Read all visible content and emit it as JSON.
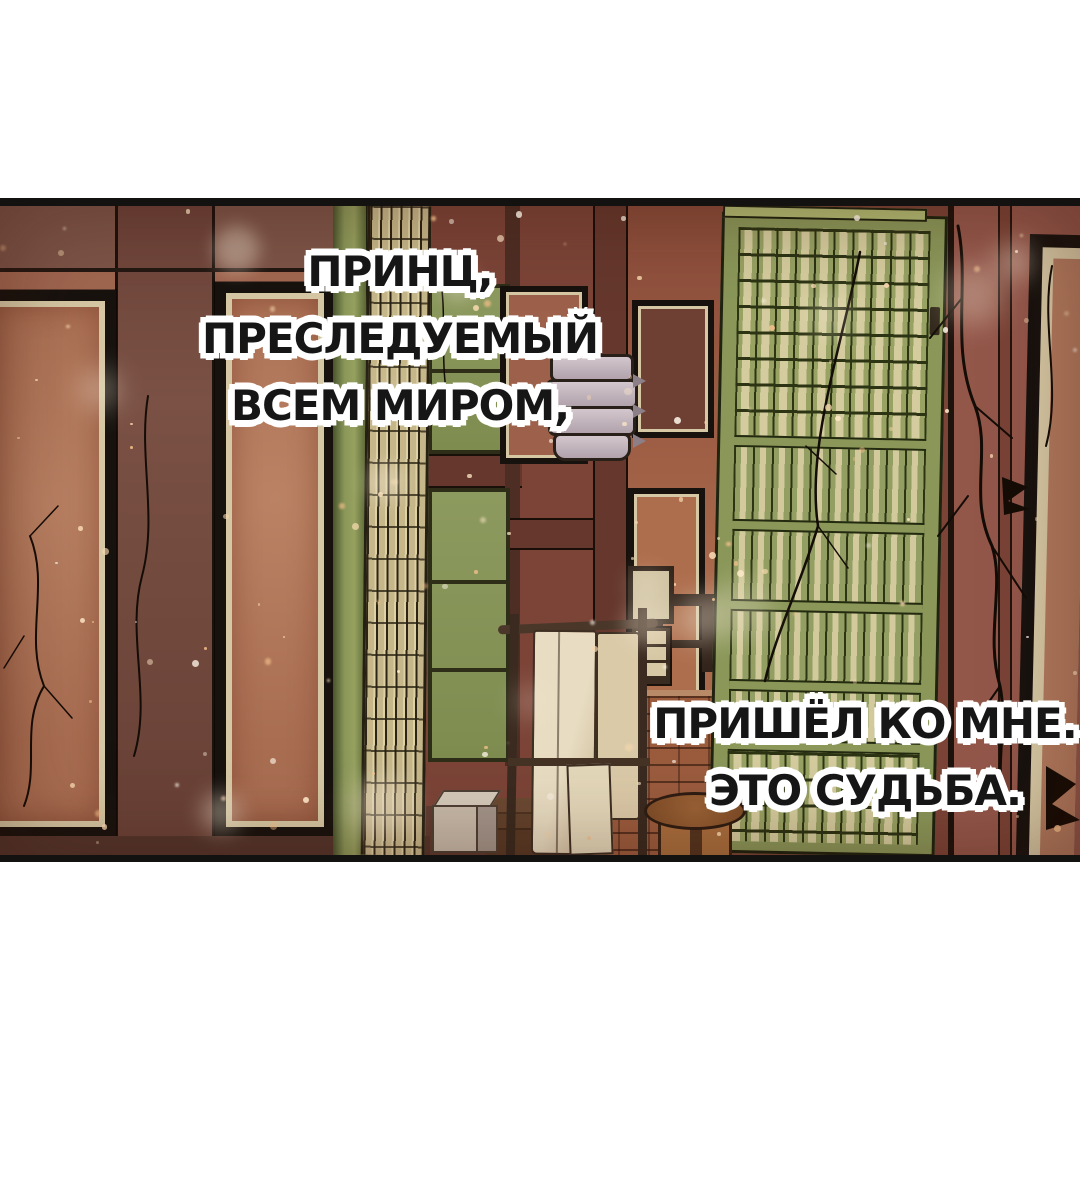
{
  "captions": [
    {
      "id": "narration-1",
      "lines": [
        "ПРИНЦ,",
        "ПРЕСЛЕДУЕМЫЙ",
        "ВСЕМ МИРОМ,"
      ],
      "text_color": "#161616",
      "outline_color": "#ffffff"
    },
    {
      "id": "narration-2",
      "lines": [
        "ПРИШЁЛ КО МНЕ.",
        "ЭТО СУДЬБА."
      ],
      "text_color": "#161616",
      "outline_color": "#ffffff"
    }
  ],
  "palette": {
    "page_bg": "#ffffff",
    "border": "#141210",
    "wall_left": "#a06750",
    "wall_top": "#7d5548",
    "wall_pillar": "#7a5144",
    "door_panel": "#a96e52",
    "trim_cream": "#d6c8a4",
    "frame_black": "#17120e",
    "green_frame": "#8a9759",
    "green_light": "#8d9a5f",
    "slat_cream": "#c6b78a",
    "interior_back": "#7b4437",
    "interior_side": "#aa6a4c",
    "beam": "#66382d",
    "brick": "#9b5c3e",
    "lantern": "#d3c7cd",
    "towel": "#e8ddc2",
    "wood_dark": "#33241b",
    "stool_wood": "#7e4d28",
    "floor_dark": "#53352c",
    "right_wall": "#93574a",
    "crack": "#140c06"
  },
  "snow": {
    "seed": 42,
    "small_count": 135,
    "large_count": 15,
    "small_colors": [
      "#fff7ea",
      "#ffe9c8",
      "#f8d9b0",
      "#f4c08a"
    ],
    "large_color": "#f7ead6"
  }
}
